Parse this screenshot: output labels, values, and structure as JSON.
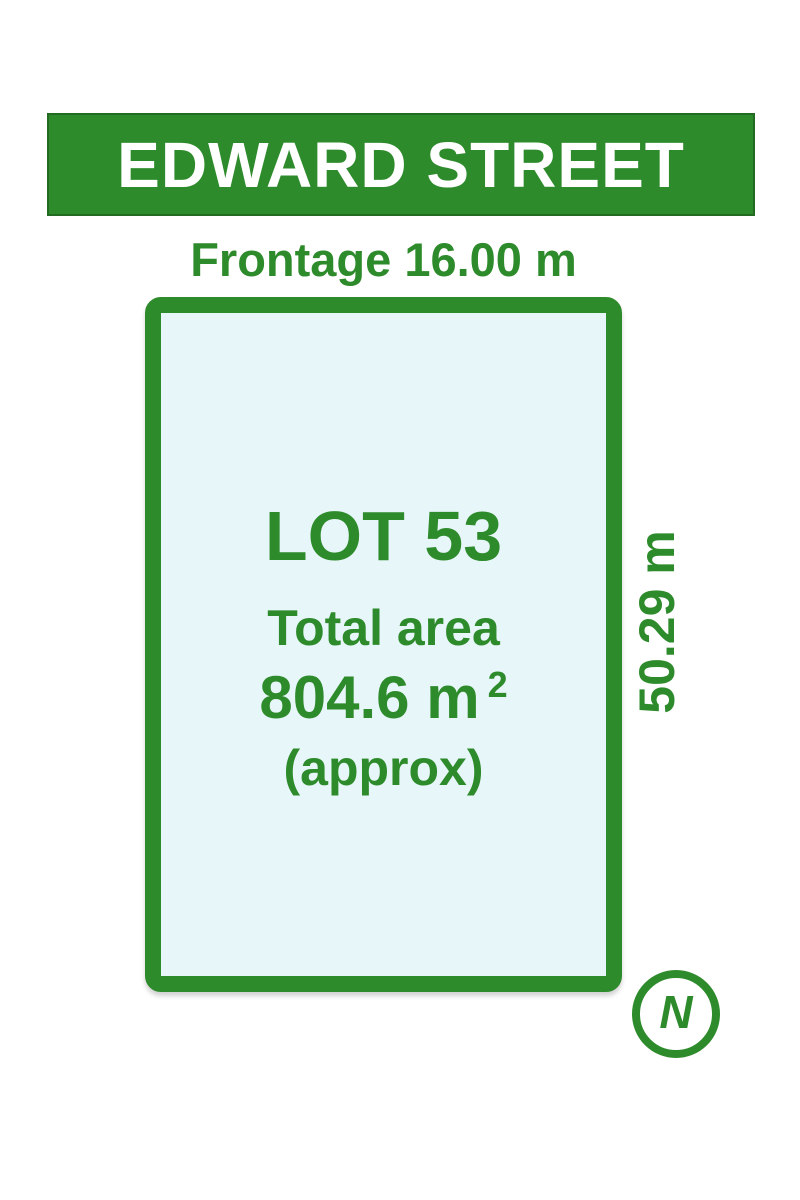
{
  "colors": {
    "green": "#2e8b2c",
    "green_dark_edge": "#236b22",
    "lot_fill": "#e7f6f9",
    "banner_text": "#ffffff",
    "background": "#ffffff"
  },
  "street_banner": {
    "label": "EDWARD STREET"
  },
  "frontage": {
    "label": "Frontage 16.00 m"
  },
  "lot": {
    "title": "LOT 53",
    "area_label": "Total area",
    "area_value": "804.6 m",
    "area_superscript": "2",
    "area_note": "(approx)"
  },
  "side_dimension": {
    "label": "50.29 m"
  },
  "compass": {
    "label": "N"
  }
}
